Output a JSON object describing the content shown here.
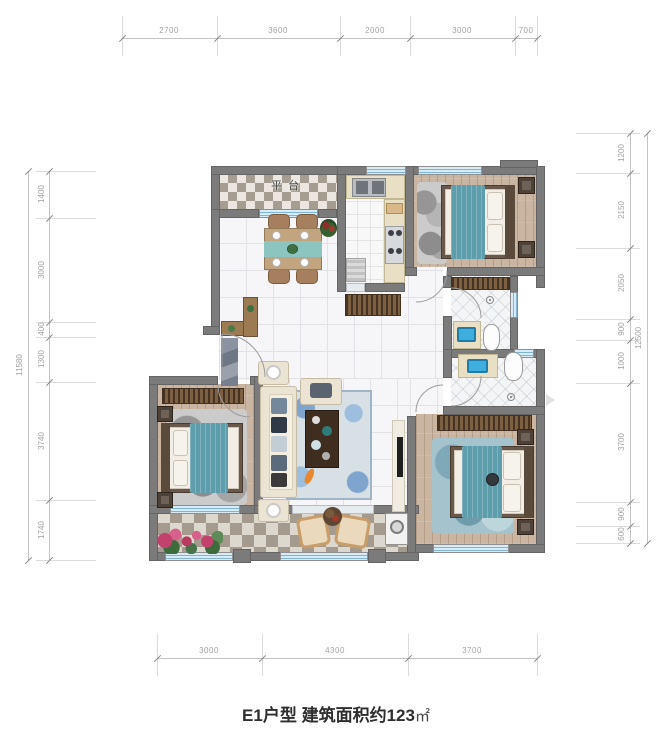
{
  "title": {
    "unit_name": "E1户型 建筑面积约123",
    "area_unit": "㎡"
  },
  "plan": {
    "room_labels": {
      "platform": "平台"
    }
  },
  "dims": {
    "top": [
      "2700",
      "3600",
      "2000",
      "3000",
      "700"
    ],
    "bottom": [
      "3000",
      "4300",
      "3700"
    ],
    "left": [
      "1400",
      "3000",
      "400",
      "1300",
      "3740",
      "1740"
    ],
    "left_total": "11580",
    "right": [
      "1200",
      "2150",
      "2050",
      "900",
      "1000",
      "3700",
      "900",
      "600"
    ],
    "right_total": "12500"
  },
  "colors": {
    "wall_gray": "#7b7b7b",
    "window_blue": "#d8ecf8",
    "accent_teal": "#5e9dab",
    "wood_floor": "#c9b5a1",
    "checker_dark": "#a59d90",
    "marble_white": "#f6f6f8",
    "rug_blue": "#a5c3cc",
    "koi_orange": "#e8872e",
    "flower_pink": "#c2416d"
  }
}
